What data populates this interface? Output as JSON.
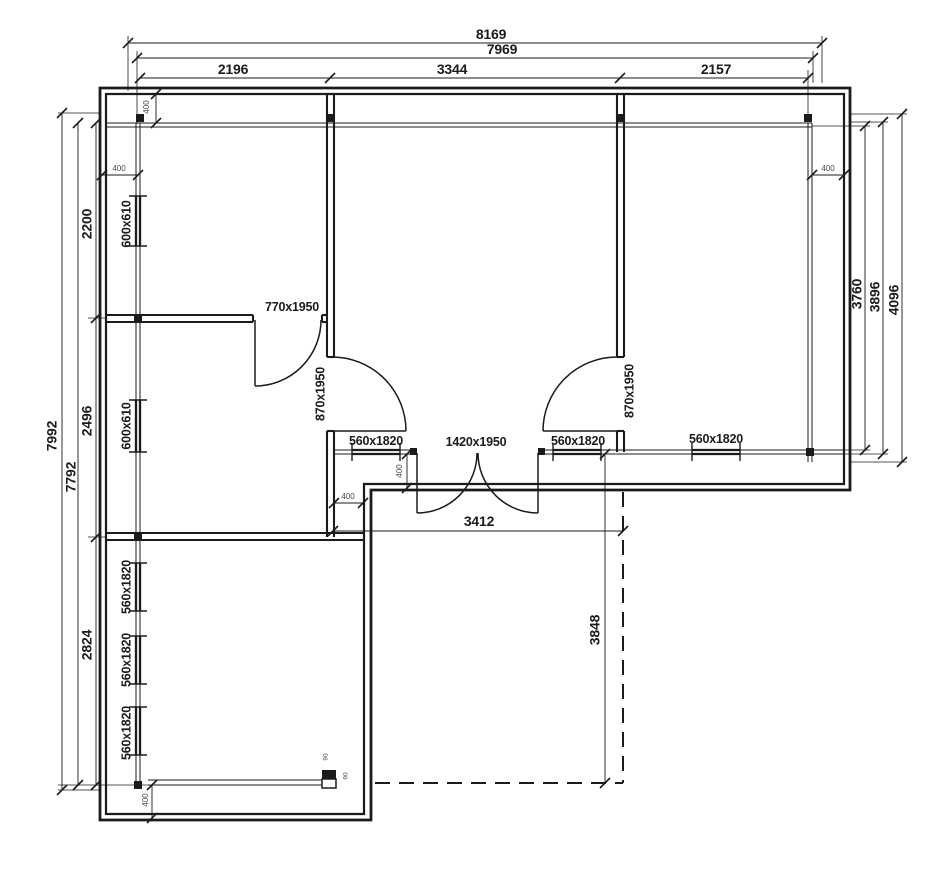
{
  "colors": {
    "ink": "#1b1b1b",
    "background": "#ffffff",
    "dim_small": "#4a4a4a"
  },
  "plan": {
    "dimensions": {
      "top": {
        "overall": "8169",
        "sub_overall": "7969",
        "segments": [
          "2196",
          "3344",
          "2157"
        ]
      },
      "left": {
        "overall": "7992",
        "sub_overall": "7792",
        "segments": [
          "2200",
          "2496",
          "2824"
        ]
      },
      "right": {
        "window_span": "3760",
        "wall_inner": "3896",
        "wall_outer": "4096"
      },
      "terrace": {
        "width": "3412",
        "depth": "3848"
      },
      "wall_offset": "400",
      "post": "90"
    },
    "openings": {
      "small_window": "600x610",
      "window": "560x1820",
      "interior_door": "770x1950",
      "room_door": "870x1950",
      "double_door": "1420x1950"
    }
  }
}
